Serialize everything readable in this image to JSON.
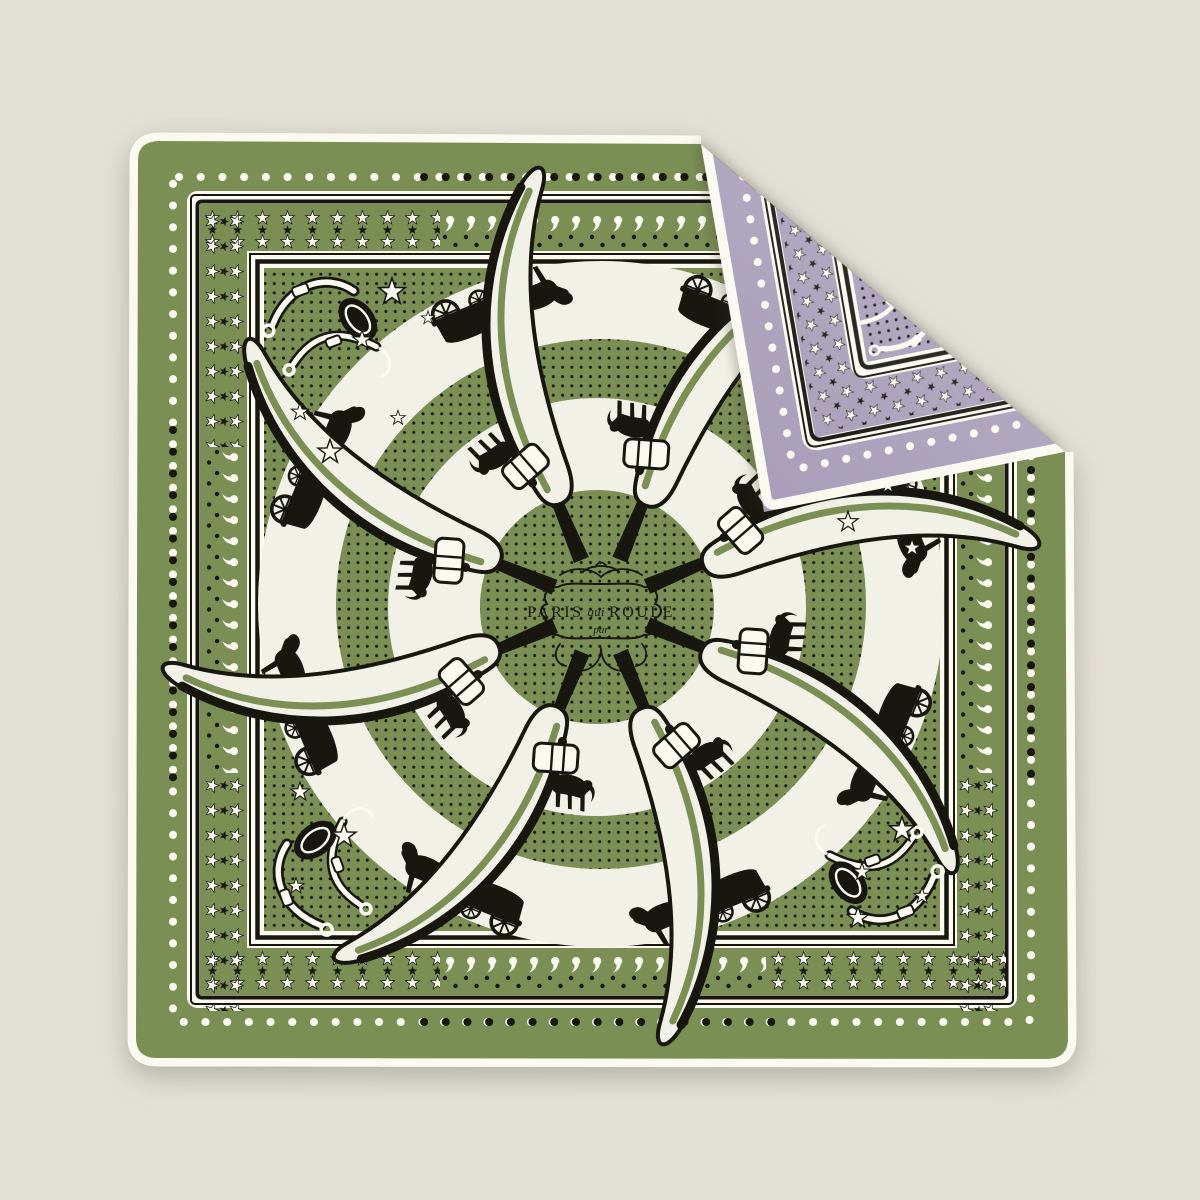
{
  "image": {
    "alt": "Folded printed silk carre scarf, green face with black carriage motifs, purple reverse shown on folded top-right corner"
  },
  "cartouche": {
    "word_left": "PARIS",
    "word_script": "qui",
    "word_right": "ROULE",
    "word_below": "par"
  },
  "colors": {
    "background": "#e3e0d7",
    "green": "#7b8f55",
    "cream": "#f2f1e7",
    "hem": "#fbfaf1",
    "black": "#17170f",
    "purple": "#a89eb9"
  },
  "motifs": {
    "front": [
      "horse-carriage-silhouette",
      "horse-silhouette",
      "whip-blade",
      "drum-roll",
      "harness-bridle",
      "star",
      "paisley",
      "polka-dot"
    ],
    "back": [
      "star",
      "polka-dot",
      "harness-bridle",
      "stripe-frame"
    ],
    "whip_blade_count": 8,
    "ring_count": 2
  }
}
